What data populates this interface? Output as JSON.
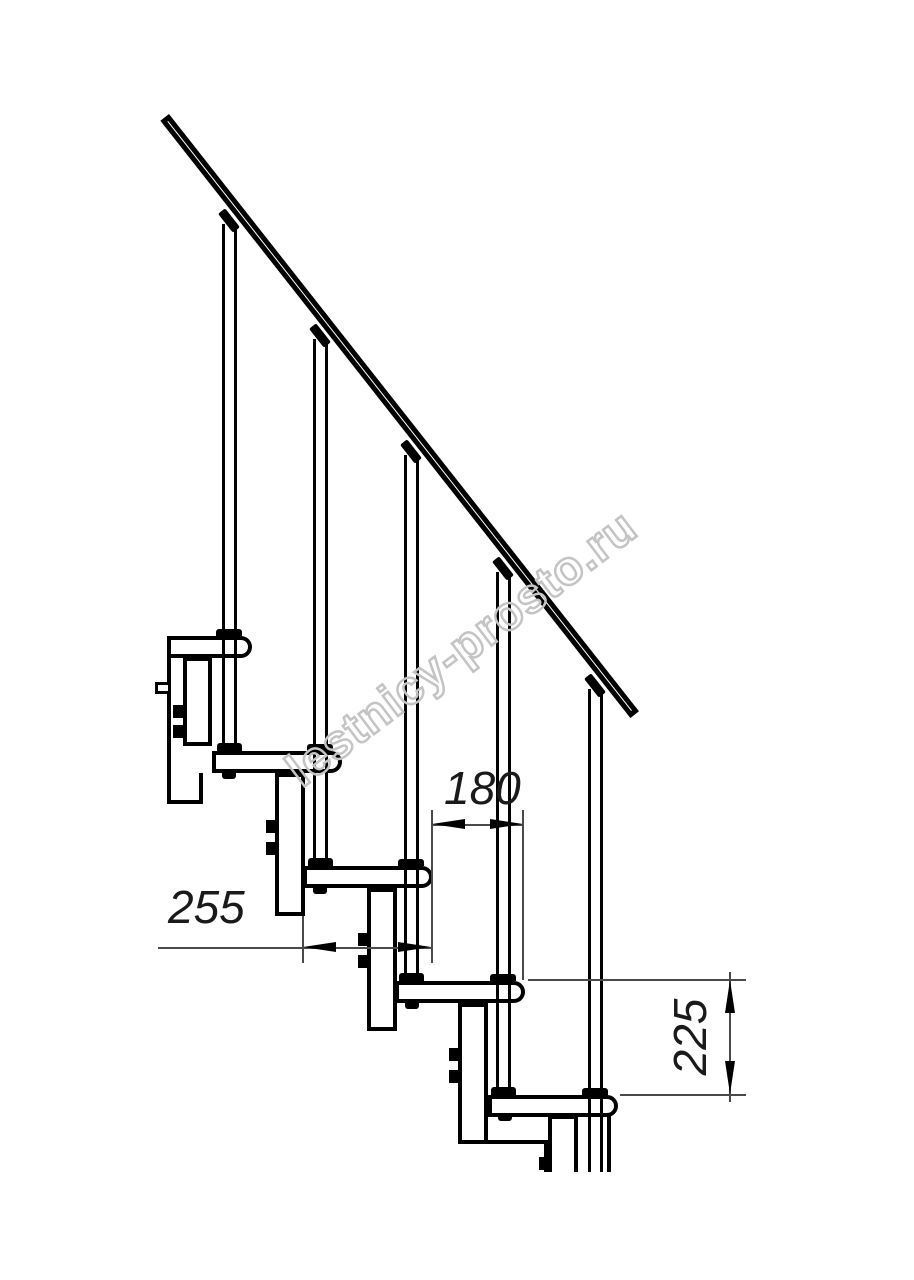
{
  "drawing": {
    "watermark_text": "lestnicy-prosto.ru",
    "dimensions": {
      "tread_depth": "255",
      "step_run": "180",
      "step_rise": "225"
    },
    "colors": {
      "line": "#000000",
      "dimension_line": "#4a4a4a",
      "dimension_text": "#1a1a1a",
      "watermark_outline": "#c4c4c4",
      "background": "#ffffff"
    }
  }
}
